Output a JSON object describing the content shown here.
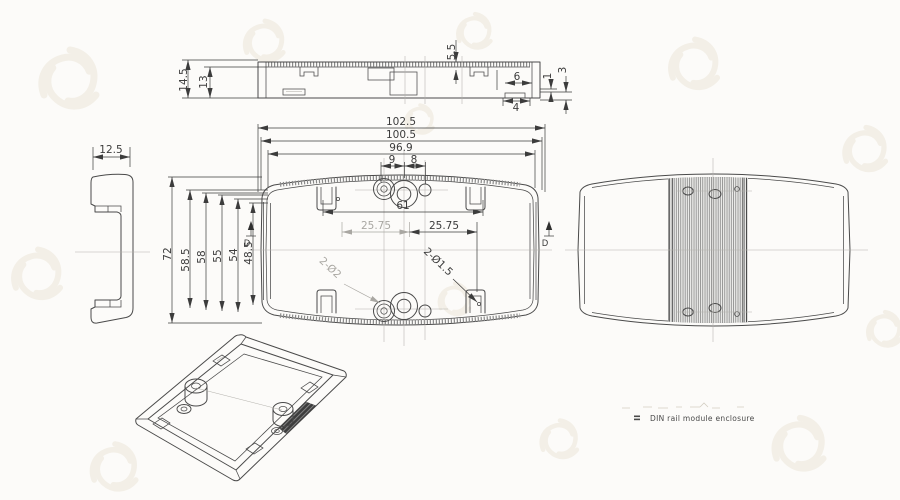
{
  "drawing": {
    "note_label": "DIN rail module enclosure",
    "section_label": "D",
    "dims": {
      "top_145": "14.5",
      "top_13": "13",
      "top_55": "5.5",
      "top_6": "6",
      "top_1": "1",
      "top_3": "3",
      "top_4": "4",
      "side_125": "12.5",
      "front_1025": "102.5",
      "front_1005": "100.5",
      "front_969": "96.9",
      "front_9": "9",
      "front_8": "8",
      "front_61": "61",
      "front_2575_left": "25.75",
      "front_2575_right": "25.75",
      "front_72": "72",
      "front_585": "58.5",
      "front_58": "58",
      "front_55": "55",
      "front_54": "54",
      "front_485": "48.5",
      "hole_note_left": "2-Ø2",
      "hole_note_right": "2-Ø1.5"
    },
    "colors": {
      "line": "#4a4a4a",
      "dim": "#3c3c3c",
      "light": "#b3b1ac",
      "ltdim": "#a9a7a2",
      "wm": "#f1ede4",
      "hatch": "#7a7a7a"
    }
  }
}
